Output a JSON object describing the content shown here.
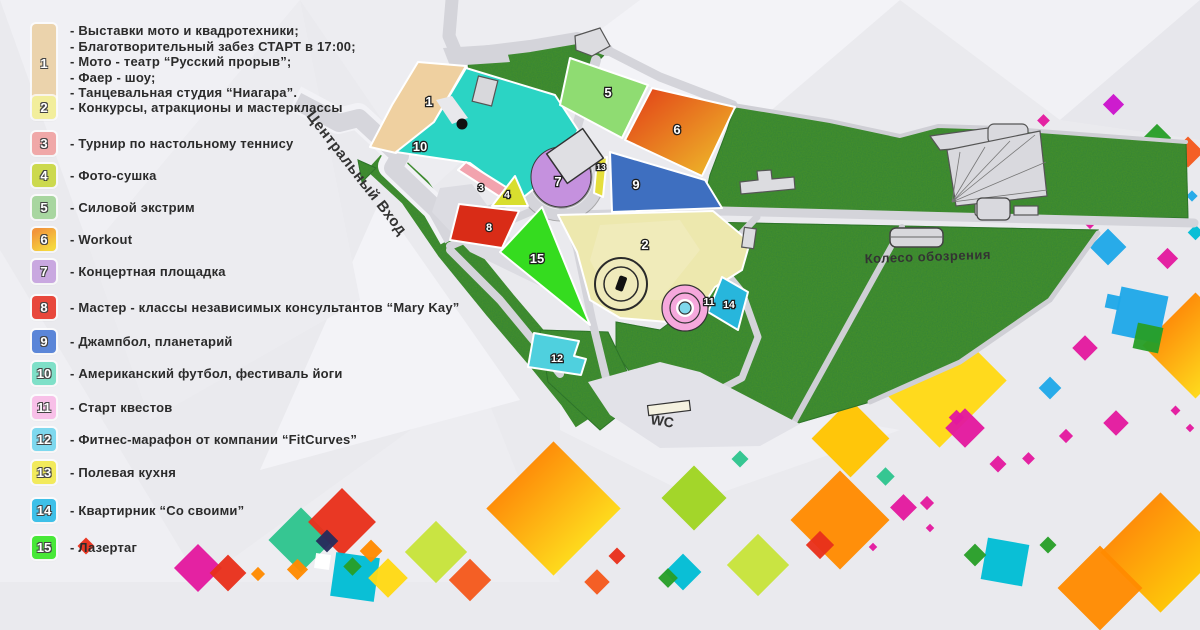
{
  "legend": {
    "items": [
      {
        "num": "1",
        "color": "#EBD3AC",
        "lines": [
          "- Выставки мото и квадротехники;",
          "- Благотворительный забез СТАРТ в 17:00;",
          "- Мото - театр “Русский прорыв”;",
          "- Фаер - шоу;",
          "- Танцевальная студия “Ниагара”."
        ]
      },
      {
        "num": "2",
        "color": "#F2EE9C",
        "lines": [
          "- Конкурсы, атракционы и мастерклассы"
        ]
      },
      {
        "num": "3",
        "color": "#F0A8A8",
        "lines": [
          "- Турнир по настольному теннису"
        ]
      },
      {
        "num": "4",
        "color": "#CCD94E",
        "lines": [
          "- Фото-сушка"
        ]
      },
      {
        "num": "5",
        "color": "#A8D6A0",
        "lines": [
          "- Силовой экстрим"
        ]
      },
      {
        "num": "6",
        "color": "linear-gradient(150deg,#F2953B 15%,#F5D73E 85%)",
        "lines": [
          "- Workout"
        ]
      },
      {
        "num": "7",
        "color": "#C9A8E0",
        "lines": [
          "- Концертная площадка"
        ]
      },
      {
        "num": "8",
        "color": "#E8483C",
        "lines": [
          "- Мастер - классы независимых консультантов “Mary Kay”"
        ]
      },
      {
        "num": "9",
        "color": "#5B86D8",
        "lines": [
          "- Джампбол, планетарий"
        ]
      },
      {
        "num": "10",
        "color": "#7FE0C8",
        "lines": [
          "- Американский футбол, фестиваль йоги"
        ]
      },
      {
        "num": "11",
        "color": "#F8C0E8",
        "lines": [
          "- Старт квестов"
        ]
      },
      {
        "num": "12",
        "color": "#7ED8EE",
        "lines": [
          "- Фитнес-марафон от компании “FitCurves”"
        ]
      },
      {
        "num": "13",
        "color": "#F2EA5C",
        "lines": [
          "- Полевая кухня"
        ]
      },
      {
        "num": "14",
        "color": "#3EC0E8",
        "lines": [
          "- Квартирник “Со своими”"
        ]
      },
      {
        "num": "15",
        "color": "#48E838",
        "lines": [
          "- Лазертаг"
        ]
      }
    ]
  },
  "map": {
    "labels": {
      "entrance": "Центральный Вход",
      "ferris": "Колесо обозрения",
      "wc": "WC"
    },
    "zone6_gradient": {
      "from": "#E23C17",
      "to": "#EFC32B"
    },
    "zones": [
      {
        "num": "1",
        "fill": "#EFD0A0"
      },
      {
        "num": "2",
        "fill": "#EDE8AE"
      },
      {
        "num": "3",
        "fill": "#F2A3AE"
      },
      {
        "num": "4",
        "fill": "#D8DE2F"
      },
      {
        "num": "5",
        "fill": "#8FDC72"
      },
      {
        "num": "6"
      },
      {
        "num": "7",
        "fill": "#C591DE"
      },
      {
        "num": "8",
        "fill": "#D92C17"
      },
      {
        "num": "9",
        "fill": "#3E6FC0"
      },
      {
        "num": "10",
        "fill": "#2BD4C4"
      },
      {
        "num": "11",
        "fill": "#F6A8DC"
      },
      {
        "num": "12",
        "fill": "#4FD0DE"
      },
      {
        "num": "13",
        "fill": "#E5DE3C"
      },
      {
        "num": "14",
        "fill": "#27B6DC"
      },
      {
        "num": "15",
        "fill": "#35DC1F"
      }
    ]
  },
  "decor": {
    "confetti_palette": [
      "#FFD914",
      "#FFC400",
      "#FF8A00",
      "#F4581C",
      "#E8301B",
      "#E3199E",
      "#CC14CC",
      "#1FA8E8",
      "#00BCD4",
      "#2EC48E",
      "#289E28",
      "#9FD421",
      "#C7E33A",
      "#262C5C",
      "#FFFFFF"
    ]
  }
}
